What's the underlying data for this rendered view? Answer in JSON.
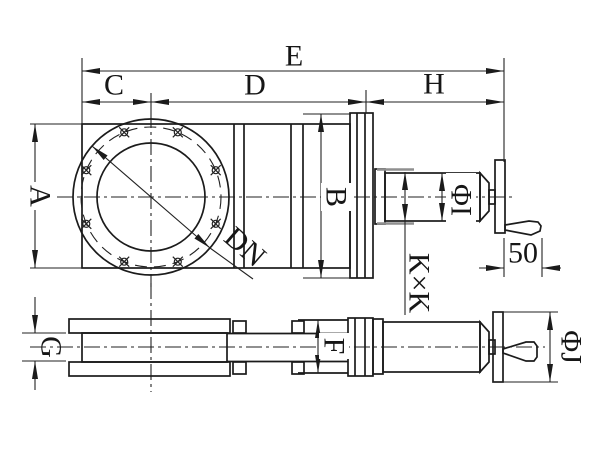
{
  "colors": {
    "line": "#1b1b1b",
    "background": "#ffffff"
  },
  "views": {
    "front": {
      "dim_overall_length": "E",
      "dim_left_to_center": "C",
      "dim_center_to_bonnet": "D",
      "dim_actuator_length": "H",
      "dim_body_height": "A",
      "dim_bonnet_height": "B",
      "dim_nominal_bore": "DN",
      "dim_cylinder_diameter": "ΦI",
      "dim_mounting_square": "K×K",
      "dim_handle_length": "50"
    },
    "side": {
      "dim_flange_thickness": "G",
      "dim_bracket_width": "F",
      "dim_handwheel_diameter": "ΦJ"
    }
  }
}
